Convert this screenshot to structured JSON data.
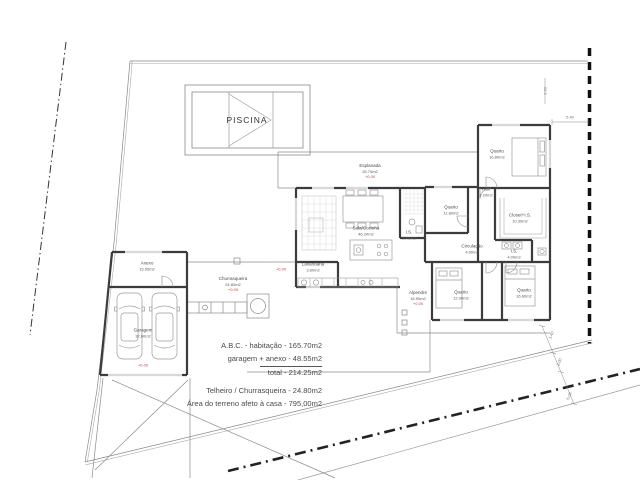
{
  "pool": {
    "label": "PISCINA"
  },
  "rooms": [
    {
      "name": "Esplanada",
      "area": "26.70m2",
      "level": "+0.00"
    },
    {
      "name": "Sala/Cozinha",
      "area": "46.20m2"
    },
    {
      "name": "Lavandaria",
      "area": "3.80m2"
    },
    {
      "name": "I.S.",
      "area": "3.40m2"
    },
    {
      "name": "Quarto",
      "area": "11.80m2"
    },
    {
      "name": "Quarto",
      "area": "16.80m2"
    },
    {
      "name": "Hall",
      "area": "2.20m2"
    },
    {
      "name": "Closet+I.S.",
      "area": "10.30m2"
    },
    {
      "name": "Circulação",
      "area": "4.60m2"
    },
    {
      "name": "I.S.",
      "area": "4.00m2"
    },
    {
      "name": "Quarto",
      "area": "12.00m2"
    },
    {
      "name": "Quarto",
      "area": "16.60m2"
    },
    {
      "name": "Anexo",
      "area": "15.95m2"
    },
    {
      "name": "Garagem",
      "area": "32.60m2",
      "level": "+0.00"
    },
    {
      "name": "Churrasqueira",
      "area": "24.80m2",
      "level": "+0.00"
    },
    {
      "name": "Alpendre",
      "area": "18.90m2",
      "level": "+0.00"
    }
  ],
  "extra_level": {
    "value": "+0.00"
  },
  "dimensions": {
    "top_width": "5.40",
    "top_height": "2.60",
    "bottom_right": [
      "1.40",
      "3.00",
      "5.08"
    ]
  },
  "summary": {
    "line1": "A.B.C. - habitação - 165.70m2",
    "line2": "garagem + anexo - 48.55m2",
    "line3": "total - 214.25m2",
    "line4": "Telheiro / Churrasqueira - 24.80m2",
    "line5": "Área do terreno afeto à casa - 795,00m2"
  },
  "colors": {
    "wall": "#3c3c3c",
    "thin_line": "#8a8a8a",
    "boundary": "#888888",
    "level_red": "#c44536"
  }
}
